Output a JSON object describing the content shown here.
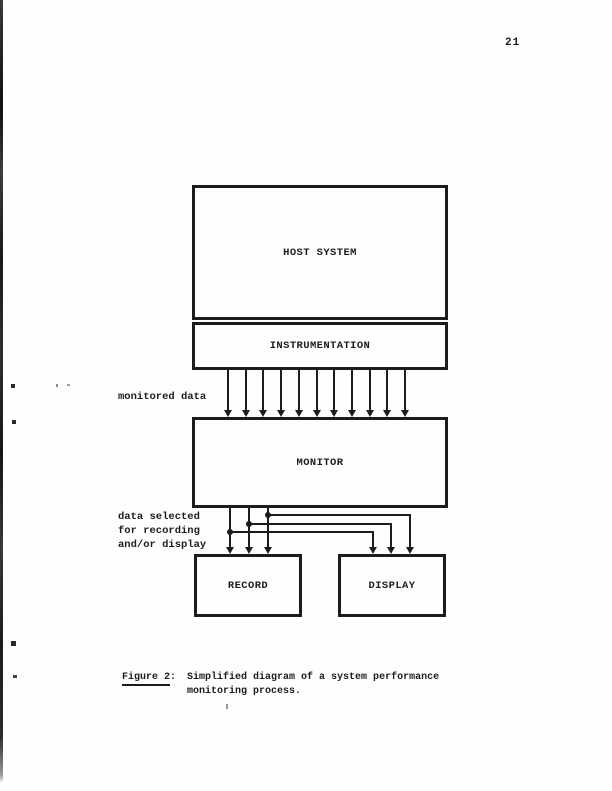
{
  "page": {
    "number": "21"
  },
  "figure": {
    "label_text": "Figure 2",
    "label_colon": ":",
    "caption_line1": "Simplified diagram of a system performance",
    "caption_line2": "monitoring process."
  },
  "diagram": {
    "nodes": [
      {
        "id": "host-system",
        "label": "HOST SYSTEM"
      },
      {
        "id": "instrumentation",
        "label": "INSTRUMENTATION"
      },
      {
        "id": "monitor",
        "label": "MONITOR"
      },
      {
        "id": "record",
        "label": "RECORD"
      },
      {
        "id": "display",
        "label": "DISPLAY"
      }
    ],
    "edge_labels": {
      "monitored_data": "monitored data",
      "data_selected_line1": "data selected",
      "data_selected_line2": "for recording",
      "data_selected_line3": "and/or display"
    },
    "monitored_arrow_count": 11,
    "branch_count": 3
  }
}
